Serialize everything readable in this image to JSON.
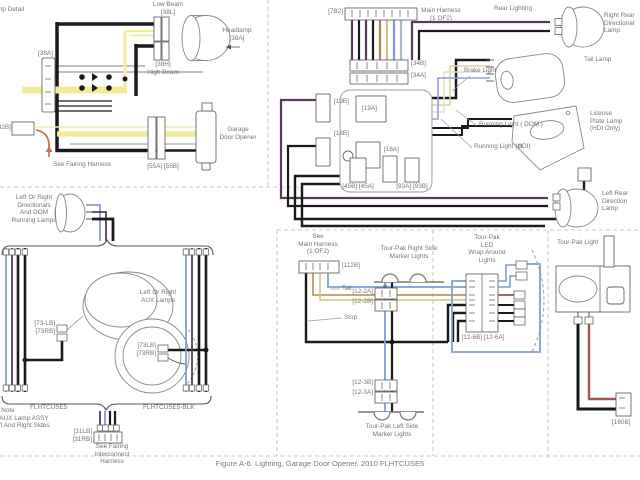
{
  "caption": "Figure A-6. Lighting, Garage Door Opener, 2010 FLHTCUSE5",
  "colors": {
    "wire_black": "#1a1a1a",
    "wire_yellow": "#f2ec9a",
    "wire_violet": "#5a3a5c",
    "wire_tan": "#b08a4a",
    "wire_gold": "#d4c47a",
    "wire_blue": "#7f9fd0",
    "wire_cream": "#ddd4a0",
    "wire_red": "#a85454",
    "wire_orange": "#c07a50",
    "outline_gray": "#888888",
    "label_text": "#757575"
  },
  "headlamp_panel": {
    "title": "Lamp Detail",
    "low_beam": "Low Beam\n[38L]",
    "headlamp": "Headlamp\n[38A]",
    "high_beam": "[38H]\nHigh Beam",
    "left_connector": "[38A]",
    "fairing_connector": "[32B]",
    "see_fairing_harness": "See Fairing Harness",
    "garage_door_opener": "Garage\nDoor Opener",
    "gdo_connectors": "[55A] [55B]"
  },
  "rear_panel": {
    "title": "Rear Lighting",
    "main_connector": "[7B2]",
    "main_harness": "Main Harness\n(1 OF2)",
    "conn_34b": "[34B]",
    "conn_34a": "[34A]",
    "conn_19b": "[19B]",
    "conn_19a": "[19A]",
    "conn_18b": "[18B]",
    "conn_18a": "[18A]",
    "conn_45": "[45B] [45A]",
    "conn_93": "[93A] [93B]",
    "brake_light": "Brake Light",
    "running_light_dom": "Running Light ( DOM )",
    "running_light_hdi": "Running Light (HDI)",
    "right_rear_directional": "Right Rear\nDirectional\nLamp",
    "tail_lamp": "Tail Lamp",
    "license_plate": "License\nPlate Lamp\n(HDI Only)",
    "left_rear_directional": "Left Rear\nDirection\nLamp"
  },
  "directional_panel": {
    "directionals_label": "Left Or Right\nDirectionals\nAnd DOM\nRunning Lamps",
    "aux_label": "Left Or Right\nAUX Lamps",
    "conn_73_left": "[73-LB]\n[73RB]",
    "conn_73_right": "[73LB]\n[73RB]",
    "model_left": "FLHTCUSE5",
    "model_right": "FLHTCUSE5-BLK",
    "conn_31": "[31LB]\n[31RB]",
    "see_fairing_interconnect": "See Fairing\nInterconnect\nHarness",
    "note": "Note\nDirectional/AUX Lamp ASSY\nOn Both Left And Right Sides"
  },
  "tourpak_panel": {
    "see_main_harness": "See\nMain Harness\n(1 OF2)",
    "conn_112b": "[112B]",
    "tail": "Tail",
    "stop": "Stop",
    "right_markers": "Tour-Pak Right Side\nMarker Lights",
    "conn_12_2a": "[12-2A]",
    "conn_12_2b": "[12-2B]",
    "led_label": "Tour-Pak\nLED\nWrap Around\nLights",
    "conn_12_6": "[12-6B] [12-6A]",
    "conn_12_3b": "[12-3B]",
    "conn_12_3a": "[12-3A]",
    "left_markers": "Tour-Pak Left Side\nMarker Lights"
  },
  "tourpak_light_panel": {
    "title": "Tour-Pak Light",
    "conn_160b": "[160B]"
  }
}
